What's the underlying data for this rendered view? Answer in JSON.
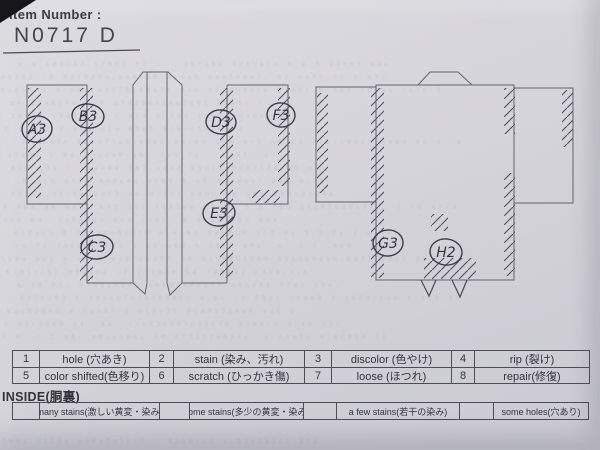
{
  "header": {
    "label": "Item Number :",
    "value": "N0717  D"
  },
  "markers": [
    {
      "label": "A3",
      "x": 37,
      "y": 129
    },
    {
      "label": "B3",
      "x": 88,
      "y": 116
    },
    {
      "label": "C3",
      "x": 97,
      "y": 247
    },
    {
      "label": "D3",
      "x": 221,
      "y": 122
    },
    {
      "label": "E3",
      "x": 219,
      "y": 213
    },
    {
      "label": "F3",
      "x": 281,
      "y": 115
    },
    {
      "label": "G3",
      "x": 388,
      "y": 243
    },
    {
      "label": "H2",
      "x": 446,
      "y": 252
    }
  ],
  "legend": {
    "rows": [
      [
        {
          "num": "1",
          "label": "hole (穴あき)"
        },
        {
          "num": "2",
          "label": "stain (染み、汚れ)"
        },
        {
          "num": "3",
          "label": "discolor (色やけ)"
        },
        {
          "num": "4",
          "label": "rip (裂け)"
        }
      ],
      [
        {
          "num": "5",
          "label": "color shifted(色移り)"
        },
        {
          "num": "6",
          "label": "scratch (ひっかき傷)"
        },
        {
          "num": "7",
          "label": "loose (ほつれ)"
        },
        {
          "num": "8",
          "label": "repair(修復)"
        }
      ]
    ]
  },
  "inside": {
    "title": "INSIDE(胴裏)",
    "options": [
      "many stains(激しい黄変・染み)",
      "some stains(多少の黄変・染み)",
      "a few stains(若干の染み)",
      "some holes(穴あり)"
    ]
  },
  "colors": {
    "paper": "#d5d4da",
    "ink": "#4a4a55",
    "outline": "#63636f"
  }
}
